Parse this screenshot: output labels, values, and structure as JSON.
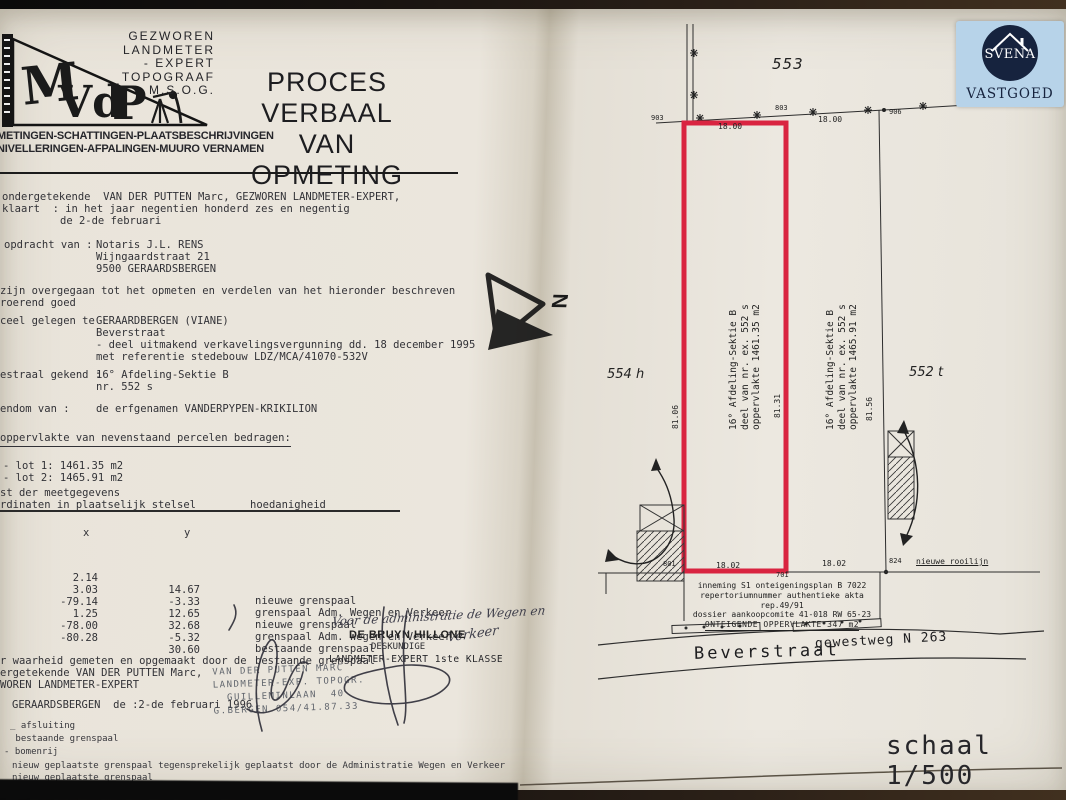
{
  "header": {
    "practice_line1": "GEZWOREN LANDMETER",
    "practice_line2": "- EXPERT",
    "practice_line3": "TOPOGRAAF",
    "practice_line4": "M.S.O.G.",
    "title_line1": "PROCES VERBAAL",
    "title_line2": "VAN OPMETING",
    "logo_letters": "MVdP",
    "services_line1": "METINGEN-SCHATTINGEN-PLAATSBESCHRIJVINGEN",
    "services_line2": "NIVELLERINGEN-AFPALINGEN-MUURO VERNAMEN"
  },
  "body": {
    "intro_line1": "ondergetekende  VAN DER PUTTEN Marc, GEZWOREN LANDMETER-EXPERT,",
    "intro_line2": "klaart  : in het jaar negentien honderd zes en negentig",
    "intro_line3": "de 2-de februari",
    "assignment_label": "opdracht van :",
    "assignment_line1": "Notaris J.L. RENS",
    "assignment_line2": "Wijngaardstraat 21",
    "assignment_line3": "9500 GERAARDSBERGEN",
    "proceed_line1": "zijn overgegaan tot het opmeten en verdelen van het hieronder beschreven",
    "proceed_line2": "roerend goed",
    "location_label": "ceel gelegen te :",
    "location_line1": "GERAARDBERGEN (VIANE)",
    "location_line2": "Beverstraat",
    "location_line3": "- deel uitmakend verkavelingsvergunning dd. 18 december 1995",
    "location_line4": "met referentie stedebouw LDZ/MCA/41070-532V",
    "cadastre_label": "estraal gekend :",
    "cadastre_line1": "16° Afdeling-Sektie B",
    "cadastre_line2": "nr. 552 s",
    "owner_label": "endom van :",
    "owner_value": "de erfgenamen VANDERPYPEN-KRIKILION",
    "area_heading": "oppervlakte van nevenstaand percelen bedragen:",
    "lot1": "- lot 1: 1461.35 m2",
    "lot2": "- lot 2: 1465.91 m2"
  },
  "measurements": {
    "list_line1": "st der meetgegevens",
    "list_line2": "rdinaten in plaatselijk stelsel",
    "quality_header": "hoedanigheid",
    "col_x": "x",
    "col_y": "y",
    "rows": [
      {
        "nr": "1",
        "x": "2.14",
        "y": "14.67",
        "desc": "nieuwe grenspaal"
      },
      {
        "nr": "2",
        "x": "3.03",
        "y": "-3.33",
        "desc": "grenspaal Adm. Wegen en Verkeer"
      },
      {
        "nr": "3",
        "x": "-79.14",
        "y": "12.65",
        "desc": "nieuwe grenspaal"
      },
      {
        "nr": "4",
        "x": "1.25",
        "y": "32.68",
        "desc": "grenspaal Adm. Wegen en Verkeer"
      },
      {
        "nr": "5",
        "x": "-78.00",
        "y": "-5.32",
        "desc": "bestaande grenspaal"
      },
      {
        "nr": "6",
        "x": "-80.28",
        "y": "30.60",
        "desc": "bestaande grenspaal"
      }
    ]
  },
  "closing": {
    "line1": "r waarheid gemeten en opgemaakt door de",
    "line2": "ergetekende VAN DER PUTTEN Marc,",
    "line3": "WOREN LANDMETER-EXPERT",
    "date_line": "GERAARDSBERGEN  de :2-de februari 1996"
  },
  "stamp": {
    "line1": "VAN DER PUTTEN MARC",
    "line2": "LANDMETER-EXP. TOPOGR.",
    "line3": "  GUILLEMINLAAN  40",
    "line4": "G.BERGEN 054/41.87.33"
  },
  "approval": {
    "handwritten_line1": "Voor de administratie de Wegen en",
    "handwritten_line2": "Verkeer",
    "name": "DE BRUYN HILLONE",
    "role1": "DESKUNDIGE",
    "role2": "LANDMETER-EXPERT 1ste KLASSE"
  },
  "legend": {
    "items": [
      {
        "symbol": "_",
        "label": "afsluiting"
      },
      {
        "symbol": "",
        "label": "bestaande grenspaal"
      },
      {
        "symbol": "-",
        "label": "bomenrij"
      },
      {
        "symbol": "",
        "label": "nieuw geplaatste grenspaal tegensprekelijk geplaatst door de Administratie Wegen en Verkeer"
      },
      {
        "symbol": "",
        "label": "nieuw geplaatste grenspaal"
      }
    ]
  },
  "plan": {
    "parcel_top": "553",
    "parcel_left": "554 h",
    "parcel_right": "552 t",
    "point_903": "903",
    "point_803": "803",
    "point_906": "906",
    "point_801": "801",
    "point_701": "701",
    "point_824": "824",
    "dist_top_left": "18.00",
    "dist_top_right": "18.00",
    "dist_bottom_left": "18.02",
    "dist_bottom_right": "18.02",
    "dim_left": "81.06",
    "dim_middle": "81.31",
    "dim_right": "81.56",
    "lot1_line1": "16° Afdeling-Sektie B",
    "lot1_line2": "deel van nr. ex. 552 s",
    "lot1_line3": "oppervlakte 1461.35 m2",
    "lot2_line1": "16° Afdeling-Sektie B",
    "lot2_line2": "deel van nr. ex. 552 s",
    "lot2_line3": "oppervlakte 1465.91 m2",
    "rooilijn_label": "nieuwe rooilijn",
    "inneming_line1": "inneming S1 onteigeningsplan B 7022",
    "inneming_line2": "repertoriumnummer authentieke akta rep.49/91",
    "inneming_line3": "dossier aankoopcomite 41-018 RW 65-23",
    "inneming_line4": "ONTEIGENDE OPPERVLAKTE 347 m2",
    "street": "Beverstraat",
    "road_ref": "gewestweg N 263",
    "scale": "schaal 1/500",
    "north_letter": "N"
  },
  "watermark": {
    "name": "SVENA",
    "subtitle": "VASTGOED"
  },
  "colors": {
    "parcel_outline": "#d92440",
    "watermark_bg": "#b7d3e9",
    "watermark_navy": "#16233e",
    "paper": "#eae5dc",
    "ink": "#2c2c30"
  }
}
